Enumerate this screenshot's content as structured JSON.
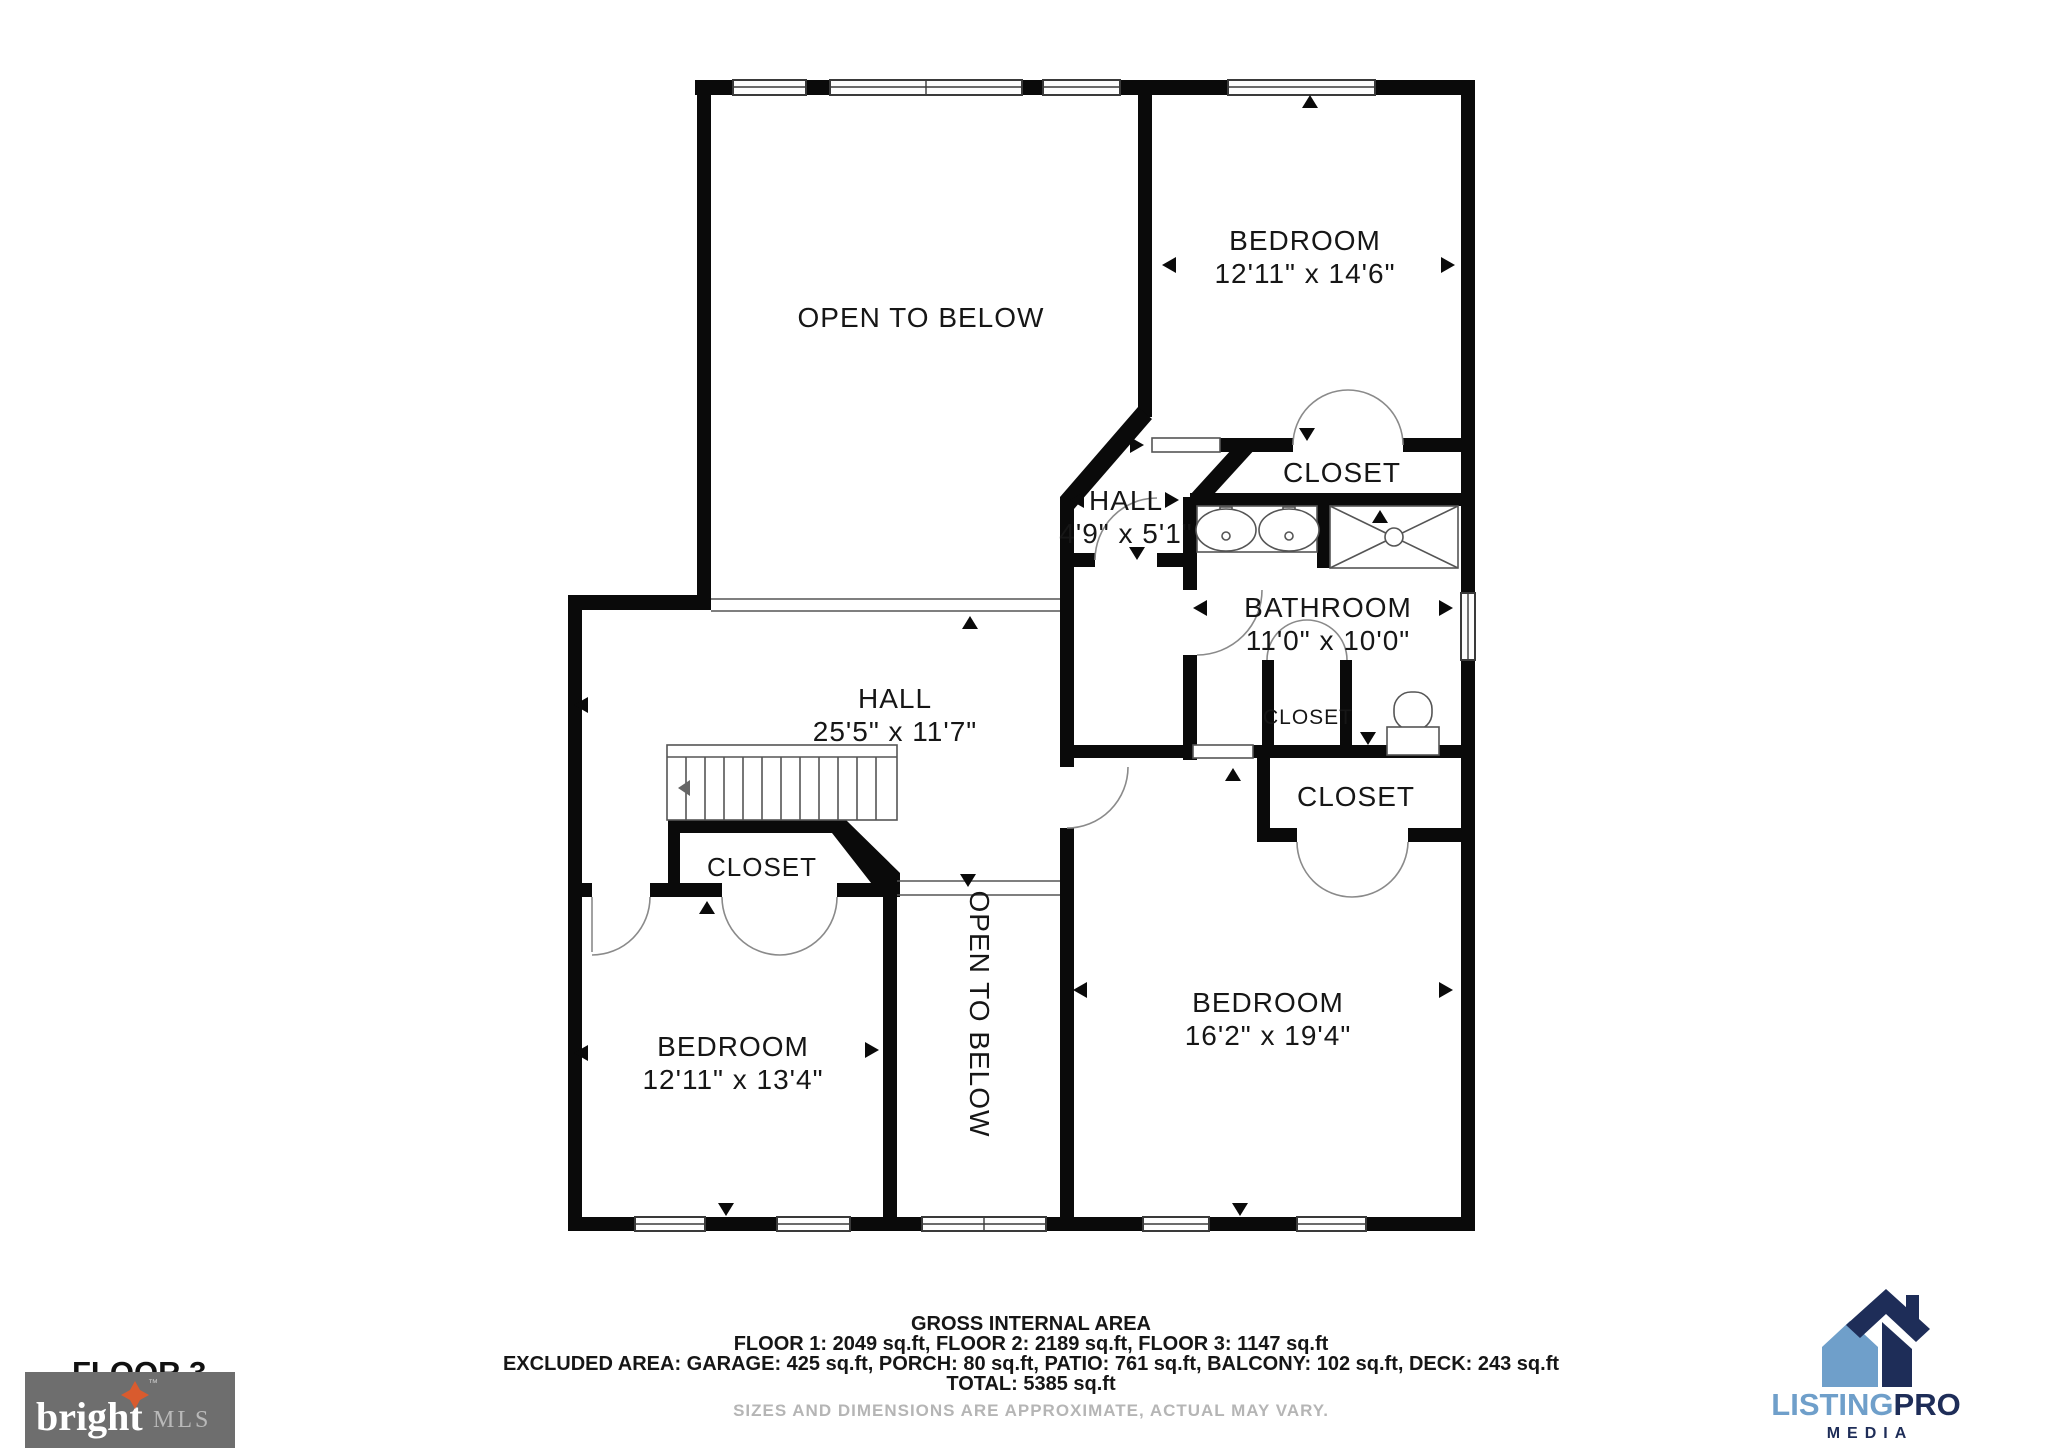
{
  "floorplan": {
    "floor_label": "FLOOR 3",
    "open_to_below_top": "OPEN TO BELOW",
    "open_to_below_mid": "OPEN TO BELOW",
    "bedroom_top": {
      "label": "BEDROOM",
      "dims": "12'11\" x 14'6\""
    },
    "closet_top": "CLOSET",
    "hall_small": {
      "label": "HALL",
      "dims": "4'9\" x 5'1\""
    },
    "bathroom": {
      "label": "BATHROOM",
      "dims": "11'0\" x 10'0\""
    },
    "closet_bathroom": "CLOSET",
    "closet_master": "CLOSET",
    "hall_main": {
      "label": "HALL",
      "dims": "25'5\" x 11'7\""
    },
    "closet_hall": "CLOSET",
    "bedroom_left": {
      "label": "BEDROOM",
      "dims": "12'11\" x 13'4\""
    },
    "bedroom_master": {
      "label": "BEDROOM",
      "dims": "16'2\" x 19'4\""
    }
  },
  "footer": {
    "title": "GROSS INTERNAL AREA",
    "line1": "FLOOR 1: 2049 sq.ft, FLOOR 2: 2189 sq.ft, FLOOR 3: 1147 sq.ft",
    "line2": "EXCLUDED AREA: GARAGE: 425 sq.ft, PORCH: 80 sq.ft, PATIO: 761 sq.ft, BALCONY: 102 sq.ft, DECK: 243 sq.ft",
    "line3": "TOTAL: 5385 sq.ft",
    "disclaimer": "SIZES AND DIMENSIONS ARE APPROXIMATE, ACTUAL MAY VARY."
  },
  "logos": {
    "bright_mls": {
      "name": "bright",
      "suffix": "MLS",
      "tm": "™",
      "bg": "#6e6e6e",
      "star_color": "#d95b2e"
    },
    "listingpro": {
      "listing": "LISTING",
      "pro": "PRO",
      "media": "MEDIA",
      "light_blue": "#6f9fca",
      "navy": "#1e2d58"
    }
  }
}
